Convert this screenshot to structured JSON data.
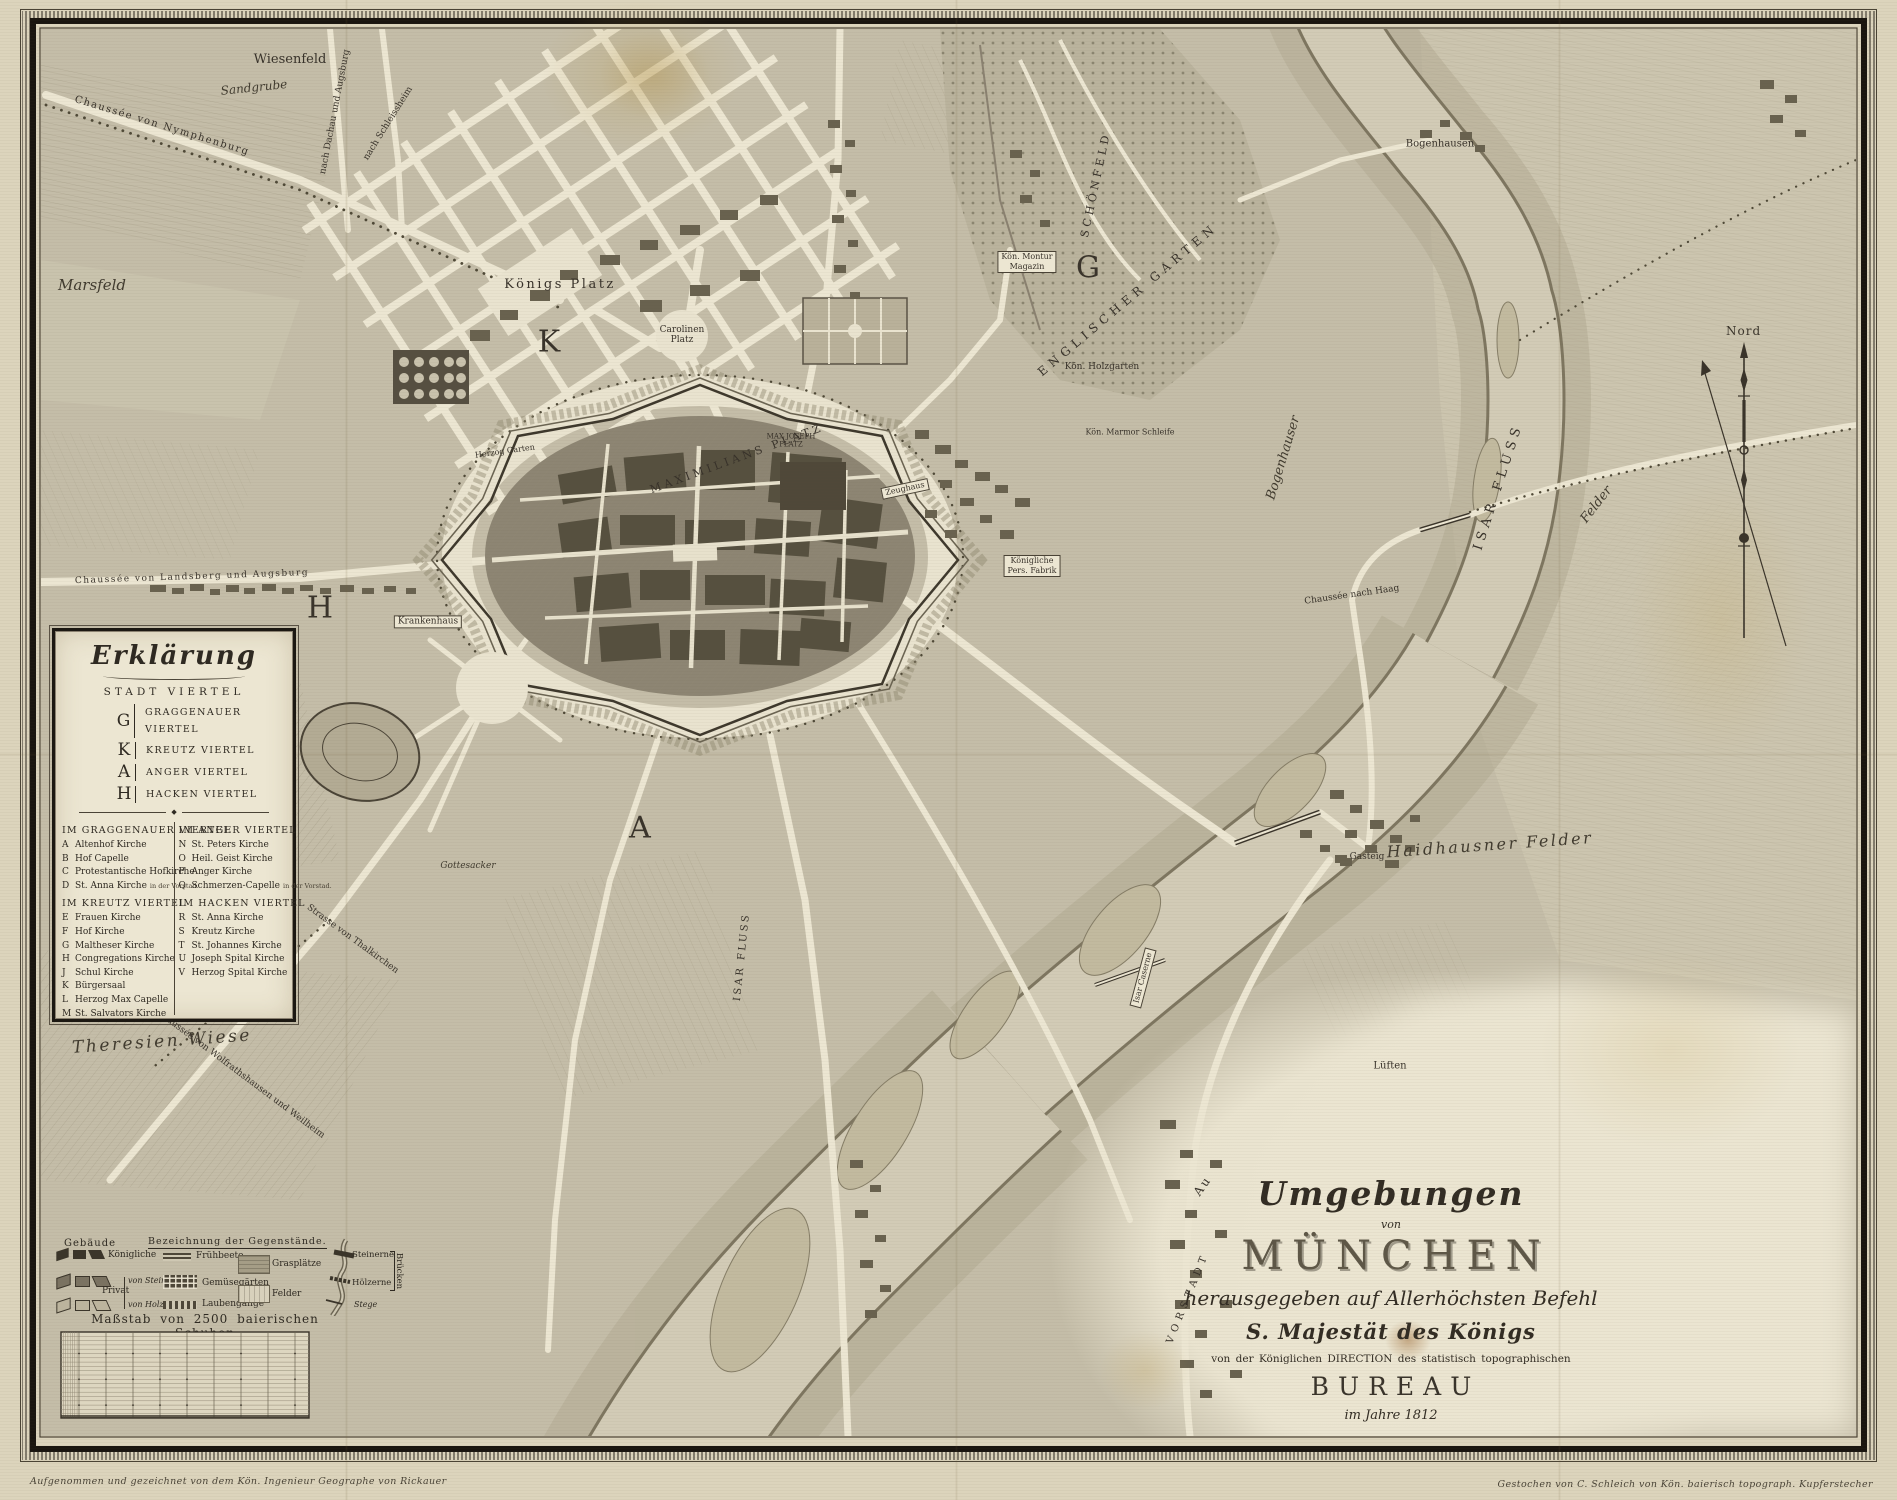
{
  "map": {
    "labels": [
      {
        "text": "Wiesenfeld",
        "x": 290,
        "y": 60,
        "size": 13,
        "cls": "roman"
      },
      {
        "text": "Sandgrube",
        "x": 254,
        "y": 88,
        "rot": -6,
        "size": 12,
        "cls": "script"
      },
      {
        "text": "Chaussée von Nymphenburg",
        "x": 162,
        "y": 126,
        "rot": 17,
        "size": 10,
        "cls": "roman sp1"
      },
      {
        "text": "nach Dachau und Augsburg",
        "x": 336,
        "y": 112,
        "rot": -79,
        "size": 9,
        "cls": "roman"
      },
      {
        "text": "nach Schleissheim",
        "x": 389,
        "y": 124,
        "rot": -58,
        "size": 9,
        "cls": "roman"
      },
      {
        "text": "Marsfeld",
        "x": 92,
        "y": 285,
        "size": 15,
        "cls": "script"
      },
      {
        "text": "Königs Platz",
        "x": 560,
        "y": 285,
        "size": 13,
        "cls": "roman sp2"
      },
      {
        "text": "K",
        "x": 549,
        "y": 342,
        "size": 30,
        "cls": "letter"
      },
      {
        "lines": [
          "Carolinen",
          "Platz"
        ],
        "x": 682,
        "y": 336,
        "size": 9,
        "cls": "roman"
      },
      {
        "text": "Maximilians Platz",
        "x": 737,
        "y": 459,
        "rot": -20,
        "size": 11,
        "cls": "roman caps sp3"
      },
      {
        "text": "Schönfeld",
        "x": 1096,
        "y": 185,
        "rot": -78,
        "size": 11,
        "cls": "roman caps sp3"
      },
      {
        "text": "Englischer Garten",
        "x": 1128,
        "y": 300,
        "rot": -40,
        "size": 12,
        "cls": "roman caps sp4"
      },
      {
        "lines": [
          "Kön. Montur",
          "Magazin"
        ],
        "x": 1027,
        "y": 262,
        "size": 8,
        "cls": "boxed"
      },
      {
        "text": "G",
        "x": 1088,
        "y": 268,
        "size": 30,
        "cls": "letter"
      },
      {
        "text": "Kön. Holzgarten",
        "x": 1102,
        "y": 368,
        "size": 9,
        "cls": "roman"
      },
      {
        "text": "Kön. Marmor Schleife",
        "x": 1130,
        "y": 433,
        "size": 8,
        "cls": "roman"
      },
      {
        "text": "Zeughaus",
        "x": 905,
        "y": 489,
        "rot": -12,
        "size": 8,
        "cls": "boxed"
      },
      {
        "lines": [
          "Max Joseph",
          "Platz"
        ],
        "x": 791,
        "y": 441,
        "size": 7,
        "cls": "roman caps"
      },
      {
        "text": "Krankenhaus",
        "x": 428,
        "y": 622,
        "size": 9,
        "cls": "boxed"
      },
      {
        "text": "Herzog Garten",
        "x": 505,
        "y": 452,
        "rot": -8,
        "size": 8,
        "cls": "roman"
      },
      {
        "text": "H",
        "x": 320,
        "y": 608,
        "size": 30,
        "cls": "letter"
      },
      {
        "text": "A",
        "x": 640,
        "y": 828,
        "size": 30,
        "cls": "letter"
      },
      {
        "text": "Gottesacker",
        "x": 468,
        "y": 867,
        "size": 9,
        "cls": "script"
      },
      {
        "text": "Chaussée von Landsberg und Augsburg",
        "x": 192,
        "y": 578,
        "rot": -2,
        "size": 9,
        "cls": "roman sp1"
      },
      {
        "text": "Theresien Wiese",
        "x": 162,
        "y": 1042,
        "rot": -4,
        "size": 17,
        "cls": "script sp2"
      },
      {
        "text": "Strasse von Thalkirchen",
        "x": 352,
        "y": 940,
        "rot": 36,
        "size": 9,
        "cls": "roman"
      },
      {
        "text": "Chaussée von Wolfrathshausen und Weilheim",
        "x": 240,
        "y": 1075,
        "rot": 37,
        "size": 9,
        "cls": "roman"
      },
      {
        "text": "Isar Fluss",
        "x": 1499,
        "y": 487,
        "rot": -72,
        "size": 13,
        "cls": "roman caps sp4"
      },
      {
        "text": "Isar Fluss",
        "x": 742,
        "y": 957,
        "rot": -84,
        "size": 10,
        "cls": "roman caps sp2"
      },
      {
        "text": "Isar Caserne",
        "x": 1143,
        "y": 978,
        "rot": -75,
        "size": 8,
        "cls": "boxed"
      },
      {
        "text": "Bogenhauser",
        "x": 1284,
        "y": 458,
        "rot": -73,
        "size": 13,
        "cls": "script"
      },
      {
        "text": "Felder",
        "x": 1597,
        "y": 505,
        "rot": -52,
        "size": 13,
        "cls": "script"
      },
      {
        "text": "Bogenhausen",
        "x": 1440,
        "y": 144,
        "size": 10,
        "cls": "roman"
      },
      {
        "text": "Chaussée nach Haag",
        "x": 1352,
        "y": 596,
        "rot": -8,
        "size": 9,
        "cls": "roman"
      },
      {
        "text": "Haidhausner Felder",
        "x": 1490,
        "y": 845,
        "rot": -4,
        "size": 16,
        "cls": "script sp2"
      },
      {
        "text": "Gasteig",
        "x": 1367,
        "y": 858,
        "size": 9,
        "cls": "roman"
      },
      {
        "text": "Lüften",
        "x": 1390,
        "y": 1066,
        "size": 10,
        "cls": "roman"
      },
      {
        "text": "Au",
        "x": 1203,
        "y": 1186,
        "rot": -55,
        "size": 12,
        "cls": "roman sp2"
      },
      {
        "text": "Vorstadt",
        "x": 1188,
        "y": 1298,
        "rot": -68,
        "size": 10,
        "cls": "roman caps sp4"
      },
      {
        "lines": [
          "Königliche",
          "Pers. Fabrik"
        ],
        "x": 1032,
        "y": 566,
        "size": 8,
        "cls": "boxed"
      }
    ]
  },
  "legend_box": {
    "title": "Erklärung",
    "subtitle": "STADT VIERTEL",
    "divider_ornament": "◆",
    "quarters": [
      {
        "key": "G",
        "name": "GRAGGENAUER VIERTEL"
      },
      {
        "key": "K",
        "name": "KREUTZ VIERTEL"
      },
      {
        "key": "A",
        "name": "ANGER VIERTEL"
      },
      {
        "key": "H",
        "name": "HACKEN VIERTEL"
      }
    ],
    "sections": [
      {
        "heading": "IM GRAGGENAUER VIERTEL",
        "items": [
          [
            "A",
            "Altenhof Kirche"
          ],
          [
            "B",
            "Hof Capelle"
          ],
          [
            "C",
            "Protestantische Hofkirche"
          ],
          [
            "D",
            "St. Anna Kirche",
            "in der Vorstad."
          ]
        ]
      },
      {
        "heading": "IM KREUTZ VIERTEL",
        "items": [
          [
            "E",
            "Frauen Kirche"
          ],
          [
            "F",
            "Hof Kirche"
          ],
          [
            "G",
            "Maltheser Kirche"
          ],
          [
            "H",
            "Congregations Kirche"
          ],
          [
            "J",
            "Schul Kirche"
          ],
          [
            "K",
            "Bürgersaal"
          ],
          [
            "L",
            "Herzog Max Capelle"
          ],
          [
            "M",
            "St. Salvators Kirche"
          ]
        ]
      },
      {
        "heading": "IM ANGER VIERTEL",
        "items": [
          [
            "N",
            "St. Peters Kirche"
          ],
          [
            "O",
            "Heil. Geist Kirche"
          ],
          [
            "P",
            "Anger Kirche"
          ],
          [
            "Q",
            "Schmerzen-Capelle",
            "in der Vorstad."
          ]
        ]
      },
      {
        "heading": "IM HACKEN VIERTEL",
        "items": [
          [
            "R",
            "St. Anna Kirche"
          ],
          [
            "S",
            "Kreutz Kirche"
          ],
          [
            "T",
            "St. Johannes Kirche"
          ],
          [
            "U",
            "Joseph Spital Kirche"
          ],
          [
            "V",
            "Herzog Spital Kirche"
          ]
        ]
      }
    ]
  },
  "symbols_legend": {
    "gebaeude": "Gebäude",
    "heading": "Bezeichnung der Gegenstände.",
    "koenigliche": "Königliche",
    "privat": "Privat",
    "von_stein": "von Stein",
    "von_holz": "von Holz",
    "fruehbeete": "Frühbeete",
    "gemuesegaerten": "Gemüsegärten",
    "laubengaenge": "Laubengänge",
    "grasplaetze": "Grasplätze",
    "felder": "Felder",
    "steinerne": "Steinerne",
    "hoelzerne": "Hölzerne",
    "bruecken": "Brücken",
    "stege": "Stege",
    "massstab": "Maßstab von 2500 baierischen Schuhen"
  },
  "cartouche": {
    "umgebungen": "Umgebungen",
    "von": "von",
    "muenchen": "MÜNCHEN",
    "herausgegeben": "herausgegeben auf Allerhöchsten Befehl",
    "majestaet": "S. Majestät des Königs",
    "direction": "von der Königlichen DIRECTION des statistisch topographischen",
    "bureau": "BUREAU",
    "jahr": "im Jahre 1812"
  },
  "compass": {
    "north_label": "Nord"
  },
  "imprints": {
    "left": "Aufgenommen und gezeichnet von dem Kön. Ingenieur Geographe von Rickauer",
    "right": "Gestochen von C. Schleich von Kön. baierisch topograph. Kupferstecher"
  },
  "colors": {
    "paper": "#dcd4bc",
    "map_ground": "#c4bda8",
    "ink": "#2f2a22",
    "water": "#d2cbb6",
    "roads": "#ece6d2",
    "blocks": "#56503f",
    "frame": "#1a150f"
  }
}
